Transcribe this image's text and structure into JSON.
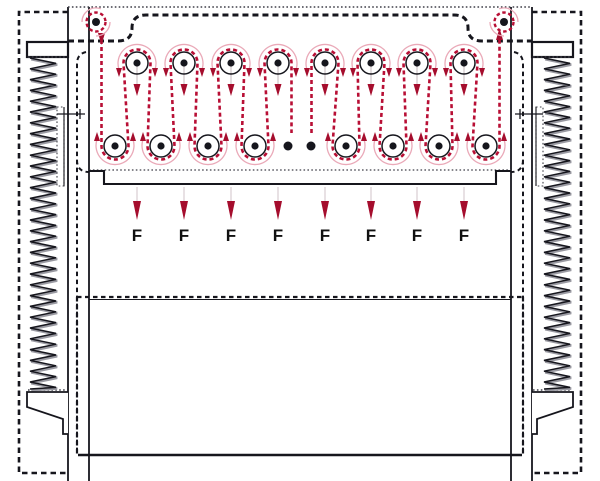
{
  "diagram": {
    "type": "press-machine-roller-belt-diagram",
    "force_label": "F",
    "force_arrow_count": 8,
    "colors": {
      "line": "#16161d",
      "belt": "#b80f35",
      "belt_light": "#eaa9b8",
      "arrow_head": "#a50d2d",
      "fine_dotted": "#3f3f48",
      "background": "#ffffff"
    },
    "rollers": {
      "top_y": 63,
      "bottom_y": 146,
      "radius": 11,
      "hub_radius": 3.6,
      "top_xs": [
        137,
        184,
        231,
        278,
        325,
        371,
        417,
        464
      ],
      "bottom_xs": [
        115,
        161,
        208,
        255,
        346,
        393,
        439,
        486
      ],
      "continuation_dot_xs": [
        288,
        311
      ],
      "continuation_dot_y": 146,
      "continuation_dot_radius": 4.5
    },
    "pulleys": {
      "y": 22,
      "xs": [
        96,
        504
      ],
      "ring_radius": 9.5
    },
    "force_arrows": {
      "xs": [
        137,
        184,
        231,
        278,
        325,
        371,
        417,
        464
      ],
      "stem_top_y": 187,
      "head_base_y": 201,
      "tip_y": 220,
      "label_y": 241
    },
    "roller_drop_arrows": {
      "stem_top_y": 63,
      "head_base_y": 84,
      "tip_y": 96
    }
  }
}
